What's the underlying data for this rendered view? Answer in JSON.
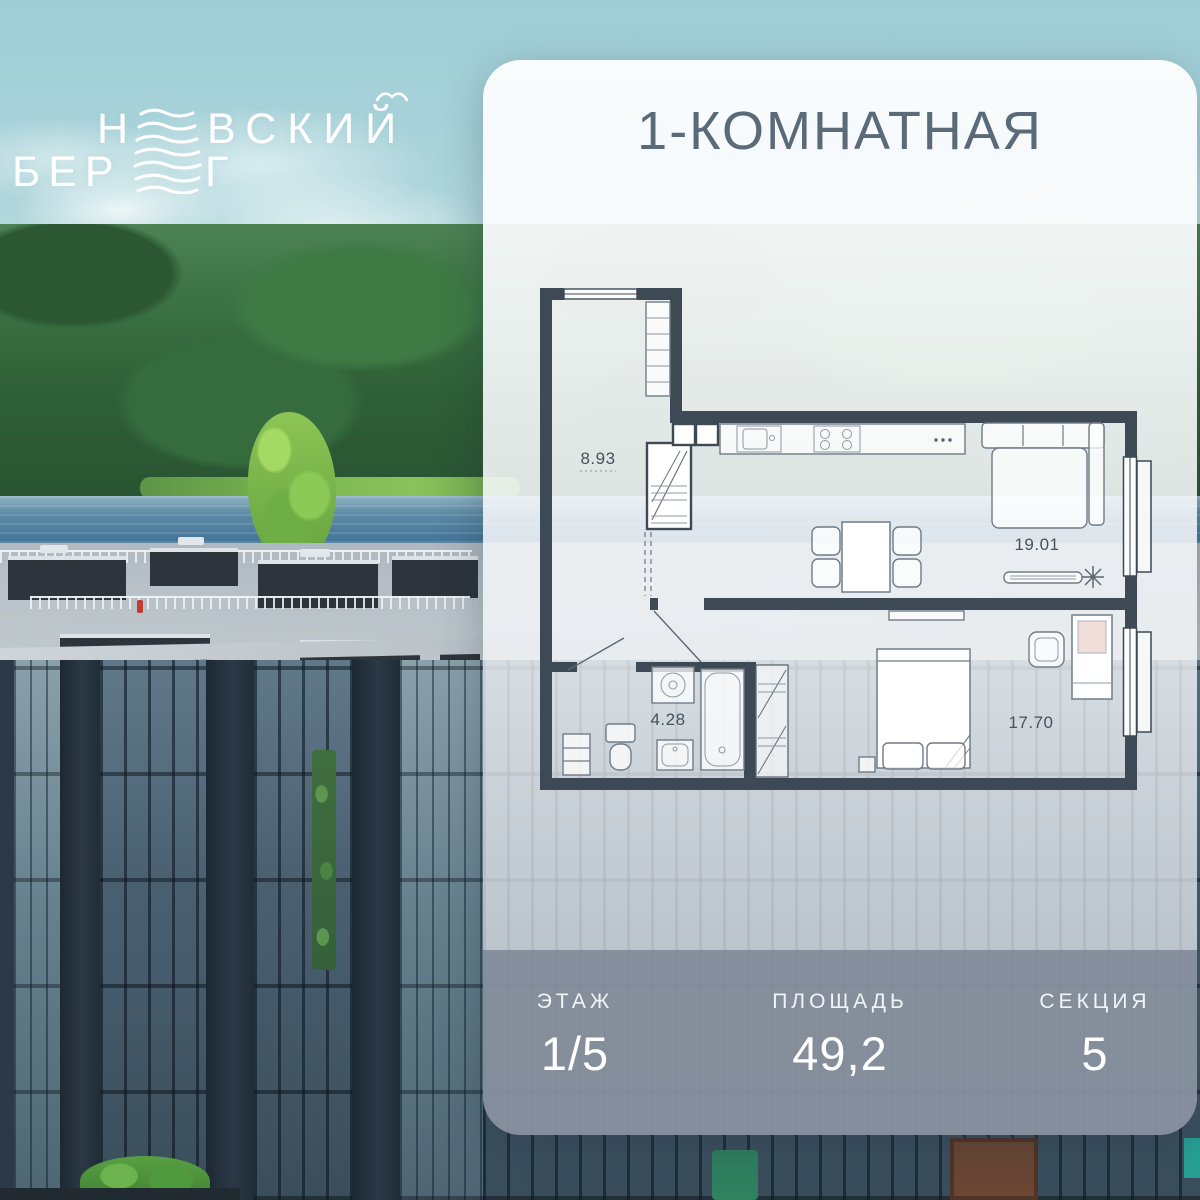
{
  "logo": {
    "word1_start": "Н",
    "word1_end": "ВСКИЙ",
    "word2_start": "БЕР",
    "word2_end": "Г"
  },
  "card": {
    "title": "1-КОМНАТНАЯ",
    "floor_plan": {
      "rooms": [
        {
          "name": "hallway",
          "area": "8.93"
        },
        {
          "name": "kitchen-living-room",
          "area": "19.01"
        },
        {
          "name": "bathroom",
          "area": "4.28"
        },
        {
          "name": "bedroom",
          "area": "17.70"
        }
      ]
    },
    "footer": {
      "stats": [
        {
          "label": "ЭТАЖ",
          "value": "1/5"
        },
        {
          "label": "ПЛОЩАДЬ",
          "value": "49,2"
        },
        {
          "label": "СЕКЦИЯ",
          "value": "5"
        }
      ]
    }
  },
  "colors": {
    "wall": "#3d4954",
    "title_text": "#5b6a78",
    "footer_bg": "rgba(118,128,144,0.78)",
    "logo_text": "#ffffff",
    "sky": "#abd4da",
    "forest": "#2f5f37",
    "water": "#49799b"
  }
}
